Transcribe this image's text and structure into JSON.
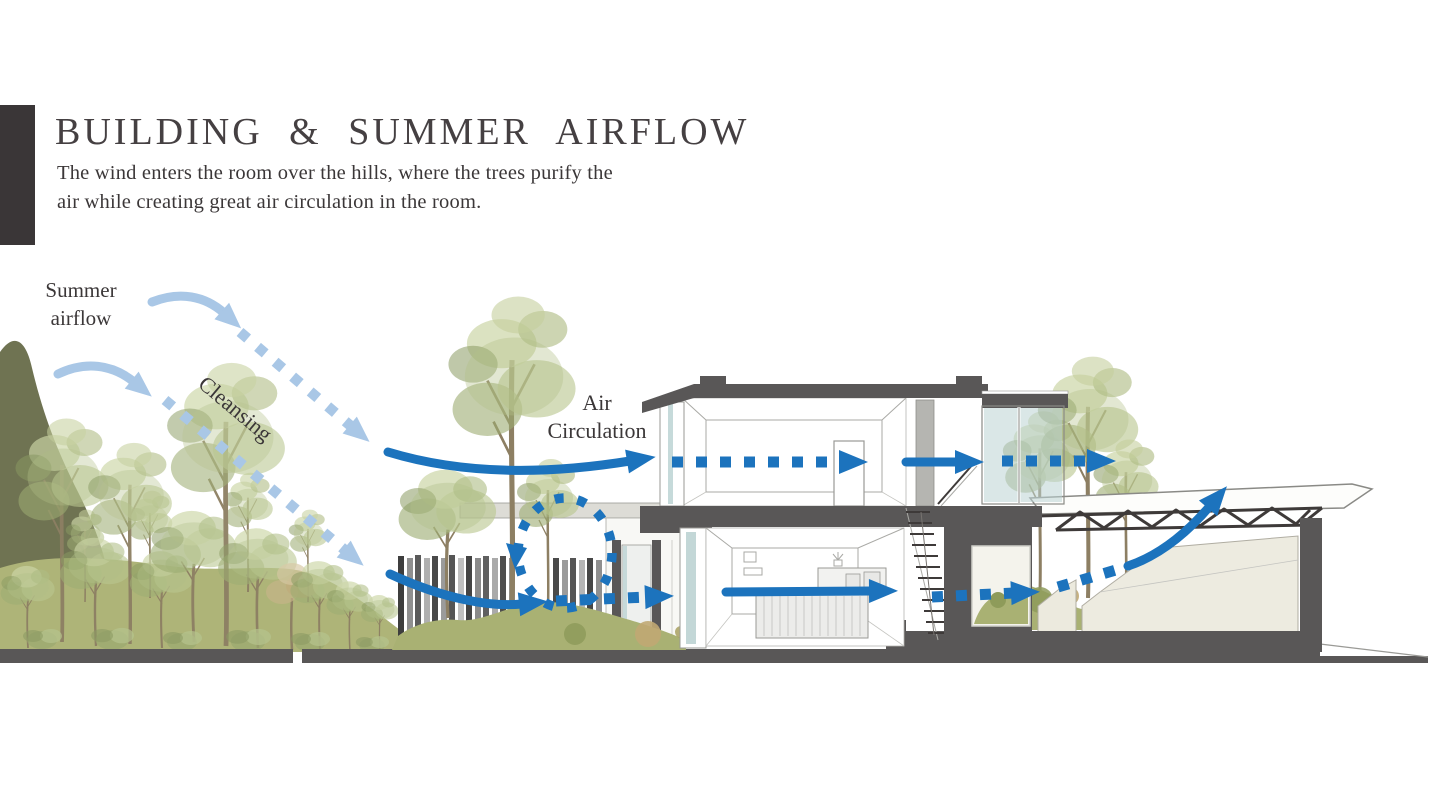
{
  "header": {
    "title": "BUILDING & SUMMER AIRFLOW",
    "subtitle_line1": "The wind enters the room over the hills, where the trees purify the",
    "subtitle_line2": "air while creating great air circulation in the room."
  },
  "labels": {
    "summer_airflow_line1": "Summer",
    "summer_airflow_line2": "airflow",
    "cleansing": "Cleansing",
    "air_circulation_line1": "Air",
    "air_circulation_line2": "Circulation"
  },
  "colors": {
    "accent_blue": "#1c73bd",
    "light_blue": "#a9c7e6",
    "poche": "#595757",
    "dark_bar": "#3a3637",
    "ink_title": "#454042",
    "ink_body": "#3b3738",
    "hill_green": "#aeb478",
    "dark_olive": "#6f7352",
    "lawn_green": "#a9b173",
    "glass_teal": "#bcd3d3",
    "beige_wall": "#edebe0",
    "truss": "#3e3a39"
  }
}
